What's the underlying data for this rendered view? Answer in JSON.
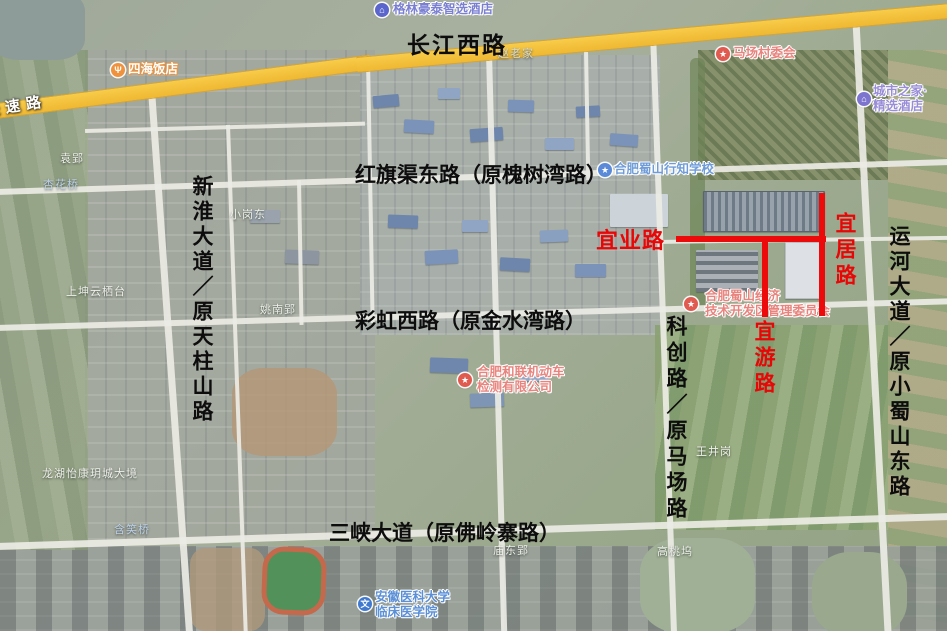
{
  "map": {
    "accent_color": "#ec0a0a",
    "highway_color": "#f3c03a",
    "road_labels": [
      {
        "text": "长江西路",
        "orientation": "horizontal"
      },
      {
        "text": "红旗渠东路（原槐树湾路）",
        "orientation": "horizontal"
      },
      {
        "text": "彩虹西路（原金水湾路）",
        "orientation": "horizontal"
      },
      {
        "text": "三峡大道（原佛岭寨路）",
        "orientation": "horizontal"
      },
      {
        "text": "新淮大道／原天柱山路",
        "orientation": "vertical"
      },
      {
        "text": "科创路／原马场路",
        "orientation": "vertical"
      },
      {
        "text": "运河大道／原小蜀山东路",
        "orientation": "vertical"
      }
    ],
    "planned_roads": [
      {
        "text": "宜业路",
        "orientation": "horizontal"
      },
      {
        "text": "宜居路",
        "orientation": "vertical"
      },
      {
        "text": "宜游路",
        "orientation": "vertical"
      }
    ],
    "pois": [
      {
        "name": "格林豪泰智选酒店",
        "icon": "hotel-bed-icon",
        "glyph": "⌂",
        "color": "#5a66cc",
        "text_color": "#7a7fd2"
      },
      {
        "name": "四海饭店",
        "icon": "restaurant-icon",
        "glyph": "Ψ",
        "color": "#f0923c",
        "text_color": "#ffffff"
      },
      {
        "name": "马场村委会",
        "icon": "star-icon",
        "glyph": "★",
        "color": "#e05a50",
        "text_color": "#e8837d"
      },
      {
        "name": "城市之家·\n精选酒店",
        "icon": "hotel-bed-icon",
        "glyph": "⌂",
        "color": "#7d74d0",
        "text_color": "#988dd6"
      },
      {
        "name": "合肥蜀山行知学校",
        "icon": "school-icon",
        "glyph": "★",
        "color": "#5b8ad8",
        "text_color": "#6f9cd8"
      },
      {
        "name": "合肥蜀山经济\n技术开发区管理委员会",
        "icon": "star-icon",
        "glyph": "★",
        "color": "#e05a50",
        "text_color": "#e8837d"
      },
      {
        "name": "合肥和联机动车\n检测有限公司",
        "icon": "star-icon",
        "glyph": "★",
        "color": "#e05a50",
        "text_color": "#e8837d"
      },
      {
        "name": "安徽医科大学\n临床医学院",
        "icon": "school-icon",
        "glyph": "文",
        "color": "#3f7ad0",
        "text_color": "#5b8fd6"
      }
    ],
    "places": [
      {
        "text": "赵老家"
      },
      {
        "text": "袁郢"
      },
      {
        "text": "杏花桥"
      },
      {
        "text": "小岗东"
      },
      {
        "text": "上坤云栖台"
      },
      {
        "text": "姚南郢"
      },
      {
        "text": "龙湖怡康玥城大境"
      },
      {
        "text": "含笑桥"
      },
      {
        "text": "王井岗"
      },
      {
        "text": "庙东郢"
      },
      {
        "text": "高桃坞"
      },
      {
        "text": "快速路"
      }
    ]
  }
}
